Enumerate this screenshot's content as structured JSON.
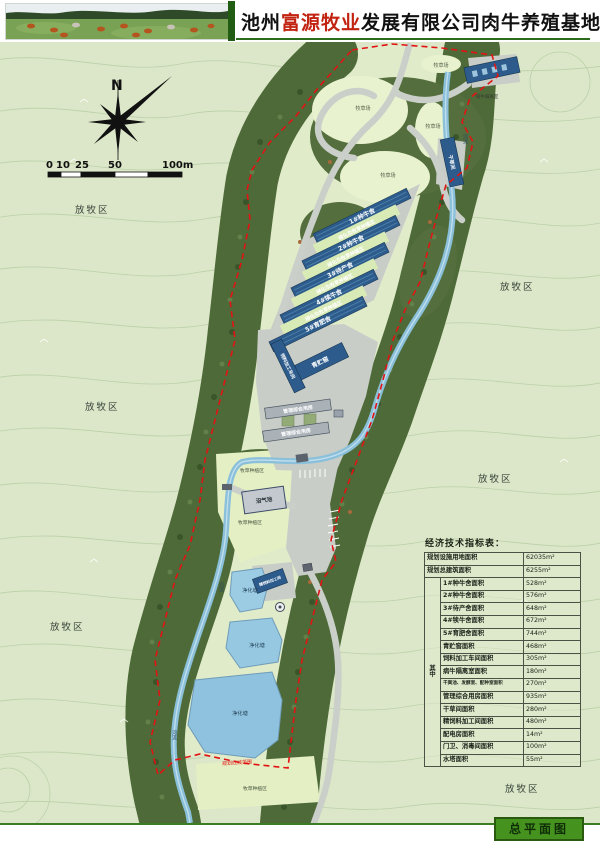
{
  "header": {
    "title_prefix": "池州",
    "title_brand": "富源牧业",
    "title_suffix": "发展有限公司肉牛养殖基地规划"
  },
  "compass": {
    "north_label": "N"
  },
  "scale_bar": {
    "ticks": [
      "0",
      "10",
      "25",
      "50",
      "100m"
    ]
  },
  "map": {
    "grazing": [
      "放牧区",
      "放牧区",
      "放牧区",
      "放牧区",
      "放牧区",
      "放牧区"
    ],
    "pasture_fields": [
      "牧草场",
      "牧草场",
      "牧草场",
      "牧草场"
    ],
    "planting_areas": [
      "牧草种植区",
      "牧草种植区",
      "牧草种植区"
    ],
    "green_strips": [
      "绿化及牧草种植区",
      "绿化及牧草种植区",
      "绿化及牧草种植区",
      "绿化及牧草种植区"
    ],
    "sheds": [
      "1#种牛舍",
      "2#种牛舍",
      "3#待产舍",
      "4#犊牛舍",
      "5#育肥舍"
    ],
    "buildings": {
      "silage": "青贮窖",
      "feed_workshop": "饲料加工车间",
      "management_upper": "管理综合用房",
      "management_lower": "管理综合用房",
      "biogas": "沼气池",
      "isolation": "病牛隔离室",
      "hay_shed": "干草间",
      "fine_feed": "精饲料加工间"
    },
    "ponds": [
      "净化塘",
      "净化塘",
      "净化塘"
    ],
    "rivers": [
      "河流",
      "河流",
      "河流"
    ],
    "boundary_note": "规划红线范围"
  },
  "table": {
    "title": "经济技术指标表：",
    "among_label": "其中",
    "rows": [
      {
        "name": "规划设施用地面积",
        "value": "62035m²"
      },
      {
        "name": "规划总建筑面积",
        "value": "6255m²"
      },
      {
        "name": "1#种牛舍面积",
        "value": "528m²"
      },
      {
        "name": "2#种牛舍面积",
        "value": "576m²"
      },
      {
        "name": "3#待产舍面积",
        "value": "648m²"
      },
      {
        "name": "4#犊牛舍面积",
        "value": "672m²"
      },
      {
        "name": "5#育肥舍面积",
        "value": "744m²"
      },
      {
        "name": "青贮窖面积",
        "value": "468m²"
      },
      {
        "name": "饲料加工车间面积",
        "value": "305m²"
      },
      {
        "name": "病牛隔离室面积",
        "value": "180m²"
      },
      {
        "name": "干粪池、发酵室、配种室面积",
        "value": "270m²"
      },
      {
        "name": "管理综合用房面积",
        "value": "935m²"
      },
      {
        "name": "干草间面积",
        "value": "280m²"
      },
      {
        "name": "精饲料加工间面积",
        "value": "480m²"
      },
      {
        "name": "配电房面积",
        "value": "14m²"
      },
      {
        "name": "门卫、消毒间面积",
        "value": "100m²"
      },
      {
        "name": "水塔面积",
        "value": "55m²"
      }
    ]
  },
  "footer": {
    "plan_label": "总平面图"
  }
}
